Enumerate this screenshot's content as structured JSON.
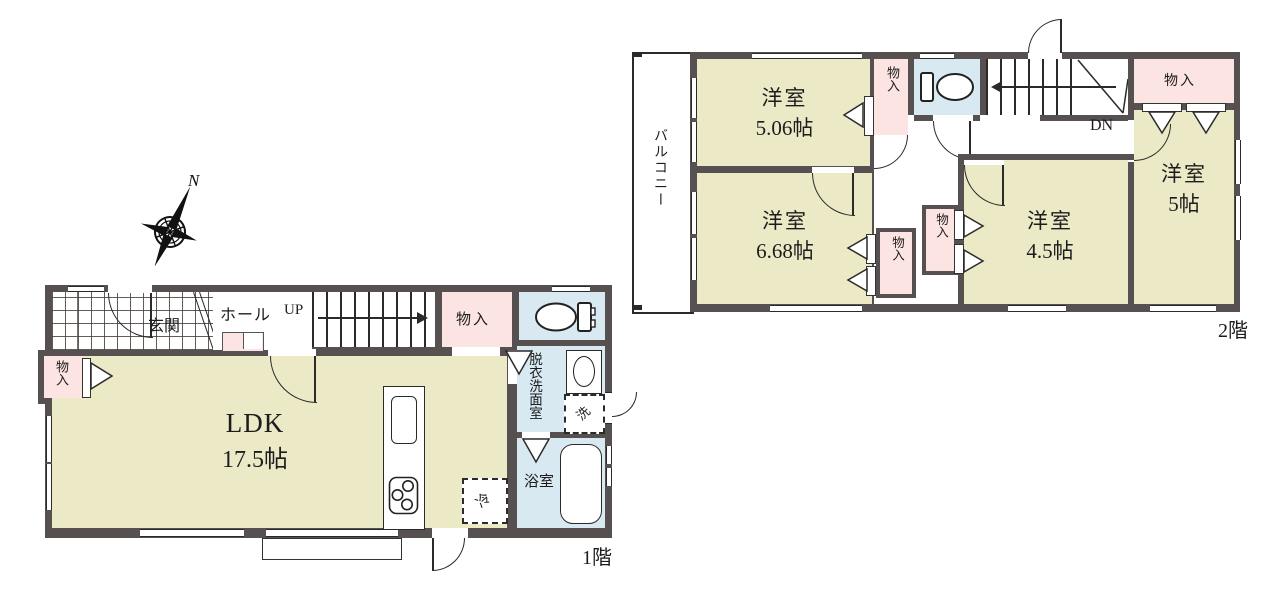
{
  "compass": {
    "north_label": "N"
  },
  "floor1": {
    "title": "1階",
    "entrance_label": "玄関",
    "hall_label": "ホール",
    "stairs_label": "UP",
    "closet_top_label": "物入",
    "closet_left_label": "物入",
    "ldk_name": "LDK",
    "ldk_size": "17.5帖",
    "washroom_label": "脱衣洗面室",
    "bath_label": "浴室",
    "washer_label": "洗",
    "fridge_label": "冷"
  },
  "floor2": {
    "title": "2階",
    "balcony_label": "バルコニー",
    "room_506_name": "洋室",
    "room_506_size": "5.06帖",
    "room_668_name": "洋室",
    "room_668_size": "6.68帖",
    "room_45_name": "洋室",
    "room_45_size": "4.5帖",
    "room_5_name": "洋室",
    "room_5_size": "5帖",
    "stairs_label": "DN",
    "closet_mid_label": "物入",
    "closet_right_label": "物入",
    "closet_45_label": "物入",
    "closet_668_label": "物入"
  },
  "colors": {
    "wall": "#575051",
    "room_fill": "#ece9c6",
    "storage_fill": "#fbe4e2",
    "wet_area_fill": "#d8e9f2",
    "background": "#ffffff"
  }
}
